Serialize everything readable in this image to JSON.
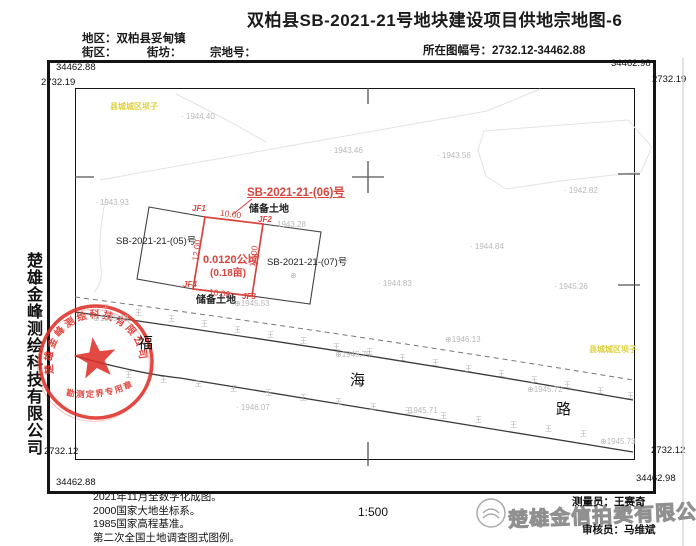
{
  "title": "双柏县SB-2021-21号地块建设项目供地宗地图-6",
  "header": {
    "district": "地区：双柏县妥甸镇",
    "street_block": "街区：",
    "street_fang": "街坊：",
    "parcel_no": "宗地号：",
    "sheet_no": "所在图幅号：2732.12-34462.88"
  },
  "frame": {
    "top_left_easting": "34462.88",
    "top_right_easting": "34462.98",
    "top_left_northing": "2732.19",
    "top_right_northing": "2732.19",
    "bottom_left_northing": "2732.12",
    "bottom_right_northing": "2732.12",
    "bottom_left_easting": "34462.88",
    "bottom_right_easting": "34462.98"
  },
  "sidebar": {
    "company": "楚雄金峰测绘科技有限公司"
  },
  "seal": {
    "ring_text": "楚雄金峰测绘科技有限公司",
    "banner_text": "勘测定界专用章",
    "color": "#dd3128"
  },
  "map": {
    "grass_symbol": "王",
    "labels": [
      {
        "cls": "ylw",
        "name": "place-label",
        "text": "县城城区坝子",
        "x": 110,
        "y": 103
      },
      {
        "cls": "ylw",
        "name": "place-label",
        "text": "县城城区坝子",
        "x": 589,
        "y": 346
      },
      {
        "cls": "elev",
        "name": "elevation-label",
        "text": "· 1944.40",
        "x": 181,
        "y": 113
      },
      {
        "cls": "elev",
        "name": "elevation-label",
        "text": "· 1943.46",
        "x": 329,
        "y": 147
      },
      {
        "cls": "elev",
        "name": "elevation-label",
        "text": "· 1943.56",
        "x": 437,
        "y": 152
      },
      {
        "cls": "elev",
        "name": "elevation-label",
        "text": "· 1943.93",
        "x": 95,
        "y": 199
      },
      {
        "cls": "elev",
        "name": "elevation-label",
        "text": "· 1942.82",
        "x": 564,
        "y": 187
      },
      {
        "cls": "elev",
        "name": "elevation-label",
        "text": "· 1944.84",
        "x": 470,
        "y": 243
      },
      {
        "cls": "elev",
        "name": "elevation-label",
        "text": "· 1944.83",
        "x": 378,
        "y": 280
      },
      {
        "cls": "elev",
        "name": "elevation-label",
        "text": "· 1945.26",
        "x": 554,
        "y": 283
      },
      {
        "cls": "elev",
        "name": "elevation-label",
        "text": "1943.28",
        "x": 277,
        "y": 221
      },
      {
        "cls": "elev",
        "name": "elevation-label",
        "text": "⊕1945.53",
        "x": 234,
        "y": 300
      },
      {
        "cls": "elev",
        "name": "elevation-label",
        "text": "⊕1945.68",
        "x": 93,
        "y": 315
      },
      {
        "cls": "elev",
        "name": "elevation-label",
        "text": "⊕1945.79",
        "x": 335,
        "y": 351
      },
      {
        "cls": "elev",
        "name": "elevation-label",
        "text": "⊕1946.13",
        "x": 445,
        "y": 336
      },
      {
        "cls": "elev",
        "name": "elevation-label",
        "text": "⊕1945.72",
        "x": 527,
        "y": 386
      },
      {
        "cls": "elev",
        "name": "elevation-label",
        "text": "· 1945.71",
        "x": 404,
        "y": 407
      },
      {
        "cls": "elev",
        "name": "elevation-label",
        "text": "· 1946.07",
        "x": 236,
        "y": 404
      },
      {
        "cls": "elev",
        "name": "elevation-label",
        "text": "⊕1945.73",
        "x": 600,
        "y": 438
      },
      {
        "cls": "elev",
        "name": "elevation-point",
        "text": "⊕",
        "x": 290,
        "y": 272
      },
      {
        "cls": "road",
        "name": "road-name",
        "text": "福",
        "x": 138,
        "y": 336
      },
      {
        "cls": "road",
        "name": "road-name",
        "text": "海",
        "x": 350,
        "y": 373
      },
      {
        "cls": "road",
        "name": "road-name",
        "text": "路",
        "x": 556,
        "y": 402
      },
      {
        "cls": "jf",
        "name": "boundary-point-label",
        "text": "JF1",
        "x": 192,
        "y": 205
      },
      {
        "cls": "jf",
        "name": "boundary-point-label",
        "text": "JF2",
        "x": 258,
        "y": 216
      },
      {
        "cls": "jf",
        "name": "boundary-point-label",
        "text": "JF3",
        "x": 242,
        "y": 293
      },
      {
        "cls": "jf",
        "name": "boundary-point-label",
        "text": "JF4",
        "x": 183,
        "y": 281
      },
      {
        "cls": "dim",
        "name": "dimension-label",
        "text": "10.00",
        "x": 220,
        "y": 210,
        "rot": 7
      },
      {
        "cls": "dim",
        "name": "dimension-label",
        "text": "10.00",
        "x": 209,
        "y": 289,
        "rot": 7
      },
      {
        "cls": "dim",
        "name": "dimension-label",
        "text": "12.00",
        "x": 186,
        "y": 246,
        "rot": -82
      },
      {
        "cls": "dim",
        "name": "dimension-label",
        "text": "12.00",
        "x": 243,
        "y": 252,
        "rot": -82
      },
      {
        "cls": "ptitle",
        "name": "parcel-label-06",
        "text": "SB-2021-21-(06)号",
        "x": 247,
        "y": 188
      },
      {
        "cls": "pres",
        "name": "land-use-label",
        "text": "储备土地",
        "x": 249,
        "y": 205
      },
      {
        "cls": "pred a1",
        "name": "parcel-area-hectare",
        "text": "0.0120公顷",
        "x": 203,
        "y": 255
      },
      {
        "cls": "pred a2",
        "name": "parcel-area-mu",
        "text": "(0.18亩)",
        "x": 210,
        "y": 269
      },
      {
        "cls": "pblk",
        "name": "parcel-label-05",
        "text": "SB-2021-21-(05)号",
        "x": 116,
        "y": 237
      },
      {
        "cls": "pblk",
        "name": "parcel-label-07",
        "text": "SB-2021-21-(07)号",
        "x": 267,
        "y": 258
      },
      {
        "cls": "pres",
        "name": "land-use-label",
        "text": "储备土地",
        "x": 196,
        "y": 296
      }
    ],
    "grass": [
      [
        102,
        305
      ],
      [
        135,
        310
      ],
      [
        168,
        316
      ],
      [
        201,
        321
      ],
      [
        234,
        327
      ],
      [
        267,
        332
      ],
      [
        300,
        338
      ],
      [
        333,
        344
      ],
      [
        366,
        349
      ],
      [
        399,
        355
      ],
      [
        432,
        360
      ],
      [
        465,
        366
      ],
      [
        498,
        371
      ],
      [
        531,
        377
      ],
      [
        564,
        382
      ],
      [
        597,
        388
      ],
      [
        627,
        393
      ],
      [
        125,
        372
      ],
      [
        160,
        377
      ],
      [
        195,
        381
      ],
      [
        230,
        386
      ],
      [
        265,
        390
      ],
      [
        300,
        395
      ],
      [
        335,
        399
      ],
      [
        370,
        404
      ],
      [
        405,
        408
      ],
      [
        440,
        413
      ],
      [
        475,
        417
      ],
      [
        510,
        422
      ],
      [
        545,
        426
      ],
      [
        580,
        431
      ]
    ]
  },
  "footer": {
    "notes": [
      "2021年11月全数字化成图。",
      "2000国家大地坐标系。",
      "1985国家高程基准。",
      "第二次全国土地调查图式图例。"
    ],
    "scale": "1:500",
    "surveyor": "测量员：王赛奇",
    "reviewer": "审核员：马维斌",
    "watermark": "楚雄金信拍卖有限公司"
  },
  "colors": {
    "red": "#d8453e",
    "yellow": "#ddd13e",
    "elev_gray": "#b9b9b9",
    "seal_red": "#dd3128"
  }
}
